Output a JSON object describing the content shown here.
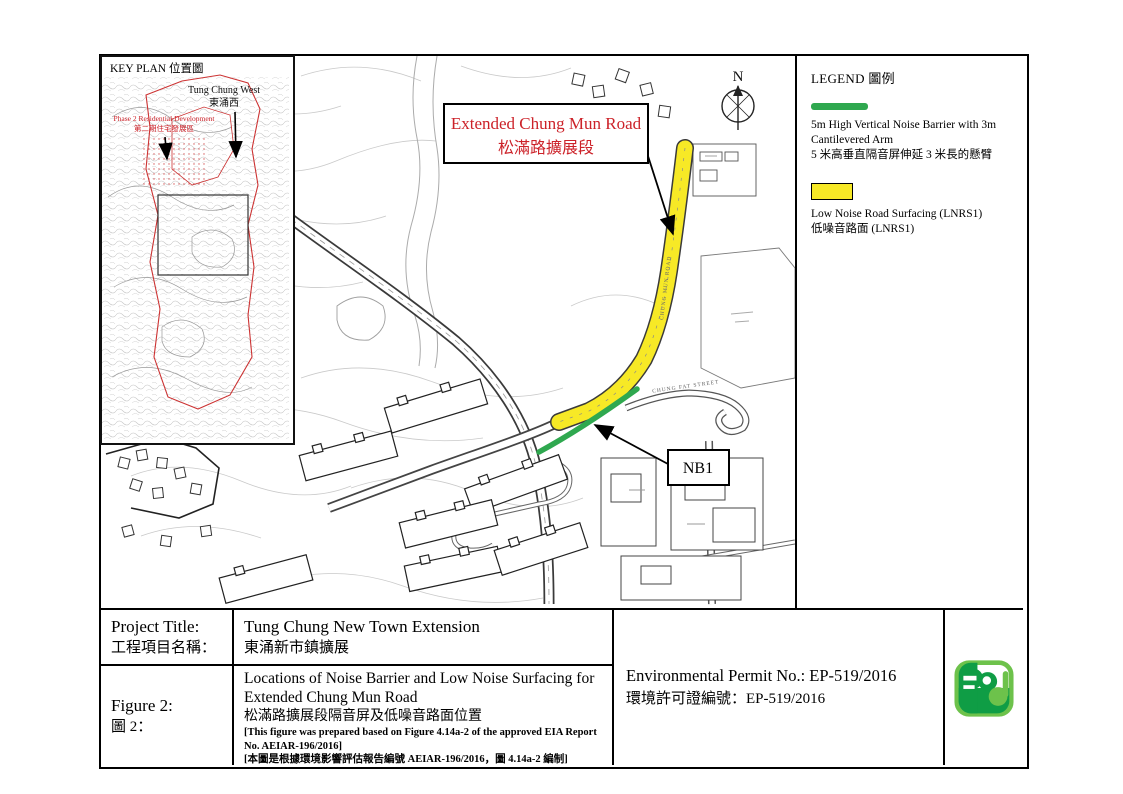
{
  "key_plan": {
    "title": "KEY PLAN  位置圖",
    "tung_chung_west_en": "Tung Chung West",
    "tung_chung_west_zh": "東涌西",
    "phase2_en": "Phase 2 Residential Development",
    "phase2_zh": "第二期住宅發展區"
  },
  "map": {
    "north_label": "N",
    "road_label_en": "Extended Chung Mun Road",
    "road_label_zh": "松滿路擴展段",
    "nb1_label": "NB1",
    "street_chung_mun": "CHUNG MUN ROAD",
    "street_chung_fat": "CHUNG FAT STREET"
  },
  "legend": {
    "title": "LEGEND  圖例",
    "items": [
      {
        "swatch": "green-bar",
        "lines": [
          "5m High Vertical Noise Barrier with 3m",
          "Cantilevered Arm",
          "5 米高垂直隔音屏伸延 3 米長的懸臂"
        ]
      },
      {
        "swatch": "yellow-box",
        "lines": [
          "Low Noise Road Surfacing (LNRS1)",
          "低噪音路面  (LNRS1)"
        ]
      }
    ]
  },
  "title_block": {
    "project_title_label_en": "Project Title:",
    "project_title_label_zh": "工程項目名稱：",
    "project_title_value_en": "Tung Chung New Town Extension",
    "project_title_value_zh": "東涌新市鎮擴展",
    "figure_label_en": "Figure 2:",
    "figure_label_zh": "圖 2：",
    "figure_title_en": "Locations of Noise Barrier and Low Noise Surfacing for Extended Chung Mun Road",
    "figure_title_zh": "松滿路擴展段隔音屏及低噪音路面位置",
    "figure_note_en": "[This figure was prepared based on Figure 4.14a-2 of the approved EIA Report No. AEIAR-196/2016]",
    "figure_note_zh": "[本圖是根據環境影響評估報告編號 AEIAR-196/2016，圖 4.14a-2 編制]",
    "permit_en": "Environmental Permit No.: EP-519/2016",
    "permit_zh": "環境許可證編號：EP-519/2016"
  },
  "colors": {
    "highlight_yellow": "#F7E926",
    "barrier_green": "#2FA84F",
    "label_red": "#CC2229",
    "logo_dark_green": "#0F9D45",
    "logo_light_green": "#6DC24B"
  }
}
